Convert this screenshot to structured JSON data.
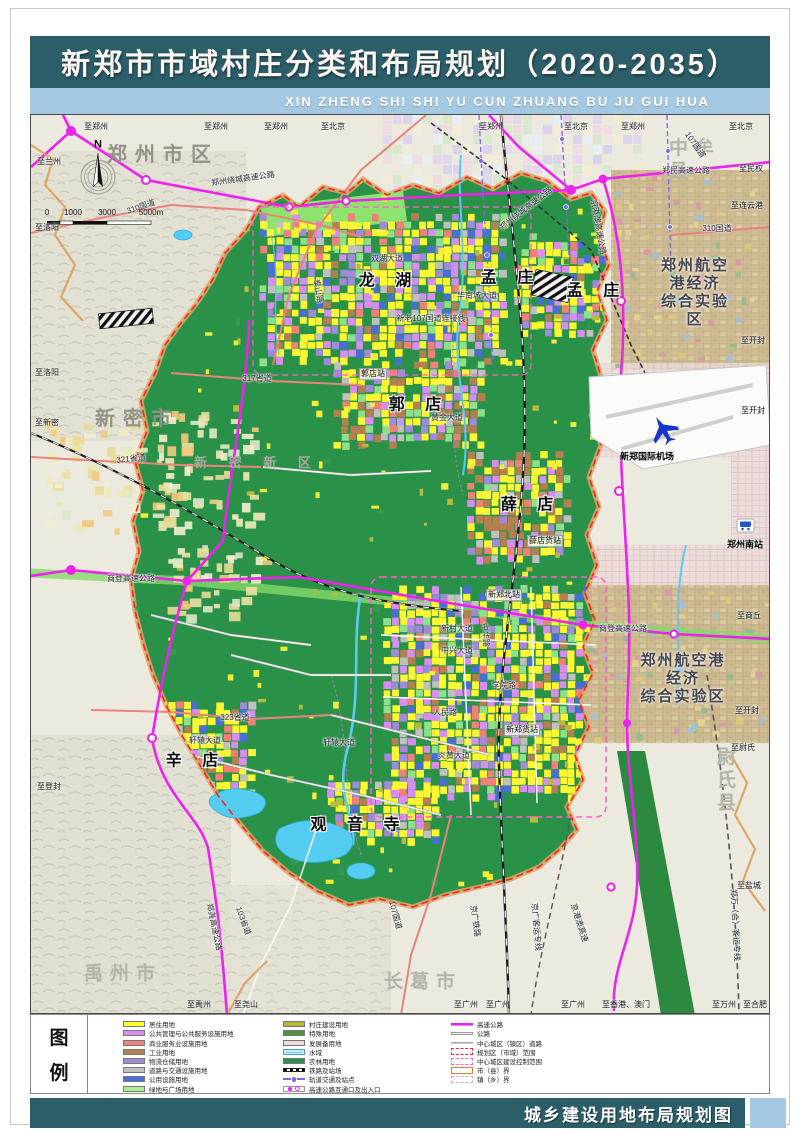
{
  "page": {
    "title": "新郑市市域村庄分类和布局规划（2020-2035）",
    "subtitle": "XIN ZHENG SHI SHI YU CUN ZHUANG BU JU GUI HUA",
    "footer": "城乡建设用地布局规划图",
    "legend_title_chars": [
      "图",
      "例"
    ]
  },
  "colors": {
    "header_teal": "#2b5e69",
    "subtitle_blue": "#a6c9e3",
    "farmland_green": "#2a9149",
    "highway_magenta": "#ee22ee",
    "boundary_red": "#ff2222",
    "control_pink": "#ff5fd0"
  },
  "compass": {
    "north_label": "N"
  },
  "scalebar": {
    "labels": [
      "0",
      "1000",
      "3000",
      "5000m"
    ]
  },
  "legend": {
    "col1": [
      {
        "label": "居住用地",
        "type": "fill",
        "color": "#ffff30"
      },
      {
        "label": "公共管理与公共服务设施用地",
        "type": "fill",
        "color": "#d88df2"
      },
      {
        "label": "商业服务业设施用地",
        "type": "fill",
        "color": "#f08078"
      },
      {
        "label": "工业用地",
        "type": "fill",
        "color": "#b48052"
      },
      {
        "label": "物流仓储用地",
        "type": "fill",
        "color": "#a18adc"
      },
      {
        "label": "道路与交通设施用地",
        "type": "fill",
        "color": "#c0c0c0"
      },
      {
        "label": "公用设施用地",
        "type": "fill",
        "color": "#4a6ed6"
      },
      {
        "label": "绿地与广场用地",
        "type": "fill",
        "color": "#aaf08c"
      }
    ],
    "col2": [
      {
        "label": "村庄建设用地",
        "type": "fill",
        "color": "#b6b73a"
      },
      {
        "label": "特殊用地",
        "type": "fill",
        "color": "#4c9140"
      },
      {
        "label": "发展备用地",
        "type": "fill",
        "color": "#eedcdc"
      },
      {
        "label": "水域",
        "type": "water",
        "color": "#6fd2f2"
      },
      {
        "label": "农林用地",
        "type": "fill",
        "color": "#2a9149"
      },
      {
        "label": "铁路及站场",
        "type": "rail",
        "color": "#000000"
      },
      {
        "label": "轨道交通及站点",
        "type": "metro",
        "color": "#7b68ee"
      },
      {
        "label": "高速公路互通口及出入口",
        "type": "interchange",
        "color": "#ee22ee"
      }
    ],
    "col3": [
      {
        "label": "高速公路",
        "type": "line",
        "color": "#ee22ee"
      },
      {
        "label": "公路",
        "type": "roadline",
        "color": "#f0f0e4"
      },
      {
        "label": "中心城区（镇区）道路",
        "type": "cityroad",
        "color": "#aaaaaa"
      },
      {
        "label": "规划区（市域）范围",
        "type": "dbox",
        "color": "#ff2222"
      },
      {
        "label": "中心城区建设控制范围",
        "type": "dbox",
        "color": "#ff5fd0"
      },
      {
        "label": "市（县）界",
        "type": "countybox",
        "color": "#e08030"
      },
      {
        "label": "镇（乡）界",
        "type": "townbox",
        "color": "#cfa8d8"
      }
    ]
  },
  "map": {
    "labels": [
      {
        "t": "郑州市区",
        "x": 132,
        "y": 40,
        "c": "region"
      },
      {
        "t": "中牟县",
        "x": 672,
        "y": 46,
        "c": "region-lt"
      },
      {
        "t": "新密市",
        "x": 106,
        "y": 304,
        "c": "region"
      },
      {
        "t": "新 密 新 区",
        "x": 226,
        "y": 348,
        "c": "region2"
      },
      {
        "t": "禹州市",
        "x": 92,
        "y": 860,
        "c": "region-lt"
      },
      {
        "t": "长葛市",
        "x": 392,
        "y": 868,
        "c": "region-lt"
      },
      {
        "t": "尉氏县",
        "x": 704,
        "y": 666,
        "c": "region-lt"
      },
      {
        "t": "郑州航空港经济\n综合实验区",
        "x": 664,
        "y": 178,
        "c": "zone"
      },
      {
        "t": "郑州航空港经济\n综合实验区",
        "x": 652,
        "y": 564,
        "c": "zone"
      },
      {
        "t": "龙 湖",
        "x": 358,
        "y": 166,
        "c": "town"
      },
      {
        "t": "孟 庄",
        "x": 480,
        "y": 163,
        "c": "town"
      },
      {
        "t": "孟 庄",
        "x": 566,
        "y": 176,
        "c": "town"
      },
      {
        "t": "郭 店",
        "x": 388,
        "y": 290,
        "c": "town"
      },
      {
        "t": "薛 店",
        "x": 500,
        "y": 390,
        "c": "town"
      },
      {
        "t": "辛 店",
        "x": 165,
        "y": 646,
        "c": "town"
      },
      {
        "t": "观 音 寺",
        "x": 328,
        "y": 710,
        "c": "town"
      },
      {
        "t": "新郑国际机场",
        "x": 616,
        "y": 342,
        "c": "poi"
      },
      {
        "t": "郑州南站",
        "x": 714,
        "y": 430,
        "c": "poi"
      },
      {
        "t": "郭店站",
        "x": 342,
        "y": 259,
        "c": "roadl"
      },
      {
        "t": "薛店货站",
        "x": 514,
        "y": 426,
        "c": "roadl"
      },
      {
        "t": "新郑北站",
        "x": 473,
        "y": 480,
        "c": "roadl"
      },
      {
        "t": "新郑货站",
        "x": 491,
        "y": 615,
        "c": "roadl"
      },
      {
        "t": "310国道",
        "x": 110,
        "y": 92,
        "c": "road",
        "r": -18
      },
      {
        "t": "郑州绕城高速公路",
        "x": 212,
        "y": 64,
        "c": "road",
        "r": -8
      },
      {
        "t": "郑州绕城高速公路",
        "x": 495,
        "y": 94,
        "c": "road",
        "r": -38
      },
      {
        "t": "郑民高速公路",
        "x": 655,
        "y": 56,
        "c": "road"
      },
      {
        "t": "京港澳高速公路",
        "x": 567,
        "y": 112,
        "c": "road",
        "r": 80
      },
      {
        "t": "107国道",
        "x": 664,
        "y": 30,
        "c": "road",
        "r": 55
      },
      {
        "t": "317省道",
        "x": 226,
        "y": 264,
        "c": "road"
      },
      {
        "t": "321省道",
        "x": 100,
        "y": 344,
        "c": "road",
        "r": -6
      },
      {
        "t": "新老107国道连接线",
        "x": 400,
        "y": 204,
        "c": "road"
      },
      {
        "t": "双湖大道",
        "x": 356,
        "y": 144,
        "c": "road"
      },
      {
        "t": "华南城大道",
        "x": 446,
        "y": 181,
        "c": "road"
      },
      {
        "t": "泰山路",
        "x": 287,
        "y": 176,
        "c": "road",
        "r": 80
      },
      {
        "t": "黄金大道",
        "x": 416,
        "y": 303,
        "c": "road"
      },
      {
        "t": "商登高速公路",
        "x": 100,
        "y": 464,
        "c": "road"
      },
      {
        "t": "商登高速公路",
        "x": 592,
        "y": 514,
        "c": "road"
      },
      {
        "t": "轩辕大道",
        "x": 174,
        "y": 626,
        "c": "road"
      },
      {
        "t": "轩辕大道",
        "x": 308,
        "y": 628,
        "c": "road"
      },
      {
        "t": "323省道",
        "x": 204,
        "y": 603,
        "c": "road"
      },
      {
        "t": "新村大道",
        "x": 426,
        "y": 514,
        "c": "road"
      },
      {
        "t": "中兴大道",
        "x": 426,
        "y": 536,
        "c": "road"
      },
      {
        "t": "人民路",
        "x": 414,
        "y": 598,
        "c": "road"
      },
      {
        "t": "学院路",
        "x": 473,
        "y": 571,
        "c": "road"
      },
      {
        "t": "炎黄大道",
        "x": 423,
        "y": 641,
        "c": "road"
      },
      {
        "t": "中华路",
        "x": 454,
        "y": 520,
        "c": "road",
        "r": 85
      },
      {
        "t": "郑尧高速公路",
        "x": 183,
        "y": 812,
        "c": "road",
        "r": 78
      },
      {
        "t": "103省道",
        "x": 212,
        "y": 806,
        "c": "road",
        "r": 70
      },
      {
        "t": "107国道",
        "x": 364,
        "y": 800,
        "c": "road",
        "r": 75
      },
      {
        "t": "京广铁路",
        "x": 444,
        "y": 806,
        "c": "road",
        "r": 82
      },
      {
        "t": "京广客运专线",
        "x": 505,
        "y": 812,
        "c": "road",
        "r": 85
      },
      {
        "t": "京港澳高速",
        "x": 548,
        "y": 808,
        "c": "road",
        "r": 72
      },
      {
        "t": "郑万（合）客运专线",
        "x": 704,
        "y": 810,
        "c": "road",
        "r": 87
      },
      {
        "t": "310国道",
        "x": 686,
        "y": 114,
        "c": "road"
      },
      {
        "t": "至郑州",
        "x": 65,
        "y": 12,
        "c": "edge"
      },
      {
        "t": "至郑州",
        "x": 185,
        "y": 12,
        "c": "edge"
      },
      {
        "t": "至郑州",
        "x": 245,
        "y": 12,
        "c": "edge"
      },
      {
        "t": "至北京",
        "x": 302,
        "y": 12,
        "c": "edge"
      },
      {
        "t": "至郑州",
        "x": 460,
        "y": 12,
        "c": "edge"
      },
      {
        "t": "至北京",
        "x": 545,
        "y": 12,
        "c": "edge"
      },
      {
        "t": "至郑州",
        "x": 602,
        "y": 12,
        "c": "edge"
      },
      {
        "t": "至北京",
        "x": 710,
        "y": 12,
        "c": "edge"
      },
      {
        "t": "至兰州",
        "x": 18,
        "y": 47,
        "c": "edge"
      },
      {
        "t": "至洛阳",
        "x": 16,
        "y": 113,
        "c": "edge"
      },
      {
        "t": "至洛阳",
        "x": 16,
        "y": 258,
        "c": "edge"
      },
      {
        "t": "至新密",
        "x": 16,
        "y": 308,
        "c": "edge"
      },
      {
        "t": "至登封",
        "x": 18,
        "y": 672,
        "c": "edge"
      },
      {
        "t": "至民权",
        "x": 720,
        "y": 54,
        "c": "edge"
      },
      {
        "t": "至连云港",
        "x": 716,
        "y": 91,
        "c": "edge"
      },
      {
        "t": "至开封",
        "x": 722,
        "y": 226,
        "c": "edge"
      },
      {
        "t": "至开封",
        "x": 722,
        "y": 296,
        "c": "edge"
      },
      {
        "t": "至商丘",
        "x": 718,
        "y": 501,
        "c": "edge"
      },
      {
        "t": "至开封",
        "x": 716,
        "y": 596,
        "c": "edge"
      },
      {
        "t": "至尉氏",
        "x": 712,
        "y": 633,
        "c": "edge"
      },
      {
        "t": "至盐城",
        "x": 718,
        "y": 771,
        "c": "edge"
      },
      {
        "t": "至禹州",
        "x": 168,
        "y": 890,
        "c": "edge"
      },
      {
        "t": "至尧山",
        "x": 215,
        "y": 890,
        "c": "edge"
      },
      {
        "t": "至广州",
        "x": 435,
        "y": 890,
        "c": "edge"
      },
      {
        "t": "至广州",
        "x": 467,
        "y": 890,
        "c": "edge"
      },
      {
        "t": "至广州",
        "x": 542,
        "y": 890,
        "c": "edge"
      },
      {
        "t": "至香港、澳门",
        "x": 595,
        "y": 890,
        "c": "edge"
      },
      {
        "t": "至万州",
        "x": 693,
        "y": 890,
        "c": "edge"
      },
      {
        "t": "至合肥",
        "x": 724,
        "y": 890,
        "c": "edge"
      }
    ]
  }
}
